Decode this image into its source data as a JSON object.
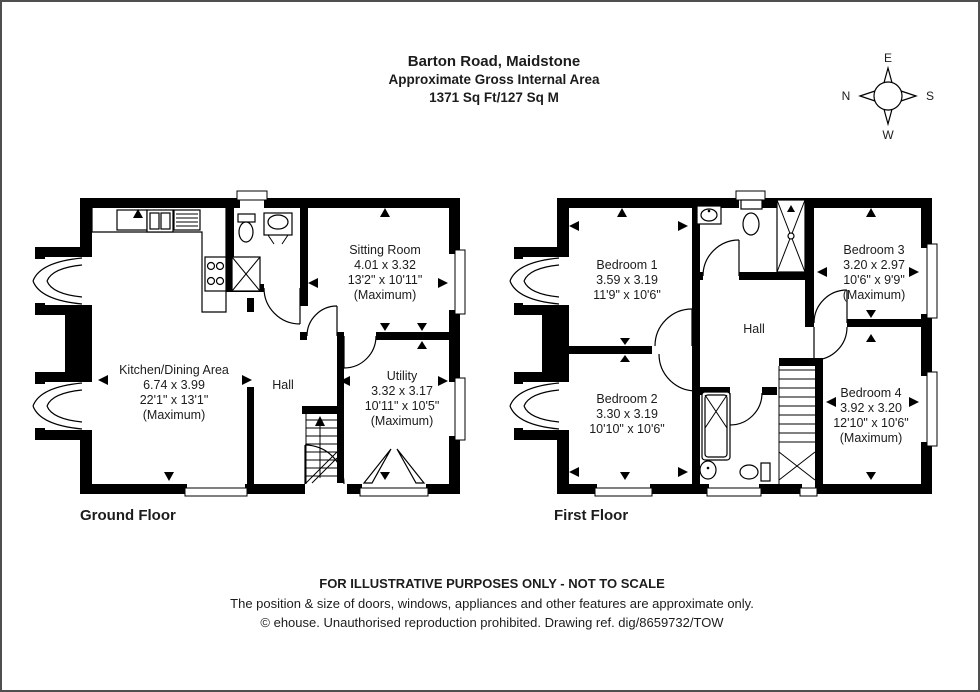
{
  "header": {
    "line1": "Barton Road, Maidstone",
    "line2": "Approximate Gross Internal Area",
    "line3": "1371 Sq Ft/127 Sq M"
  },
  "compass": {
    "top": "E",
    "right": "S",
    "bottom": "W",
    "left": "N"
  },
  "ground_floor": {
    "label": "Ground Floor",
    "sitting": {
      "name": "Sitting Room",
      "metric": "4.01 x 3.32",
      "imperial": "13'2\" x 10'11\"",
      "note": "(Maximum)"
    },
    "kitchen": {
      "name": "Kitchen/Dining Area",
      "metric": "6.74 x 3.99",
      "imperial": "22'1\" x 13'1\"",
      "note": "(Maximum)"
    },
    "utility": {
      "name": "Utility",
      "metric": "3.32 x 3.17",
      "imperial": "10'11\" x 10'5\"",
      "note": "(Maximum)"
    },
    "hall": {
      "name": "Hall"
    }
  },
  "first_floor": {
    "label": "First Floor",
    "bedroom1": {
      "name": "Bedroom 1",
      "metric": "3.59 x 3.19",
      "imperial": "11'9\" x 10'6\""
    },
    "bedroom2": {
      "name": "Bedroom 2",
      "metric": "3.30 x 3.19",
      "imperial": "10'10\" x 10'6\""
    },
    "bedroom3": {
      "name": "Bedroom 3",
      "metric": "3.20 x 2.97",
      "imperial": "10'6\" x 9'9\"",
      "note": "(Maximum)"
    },
    "bedroom4": {
      "name": "Bedroom 4",
      "metric": "3.92 x 3.20",
      "imperial": "12'10\" x 10'6\"",
      "note": "(Maximum)"
    },
    "hall": {
      "name": "Hall"
    }
  },
  "footer": {
    "line1": "FOR ILLUSTRATIVE PURPOSES ONLY - NOT TO SCALE",
    "line2": "The position & size of doors, windows, appliances and other features are approximate only.",
    "line3": "© ehouse. Unauthorised reproduction prohibited. Drawing ref. dig/8659732/TOW"
  },
  "colors": {
    "wall": "#000000",
    "background": "#ffffff",
    "frame": "#4f4f4f"
  }
}
